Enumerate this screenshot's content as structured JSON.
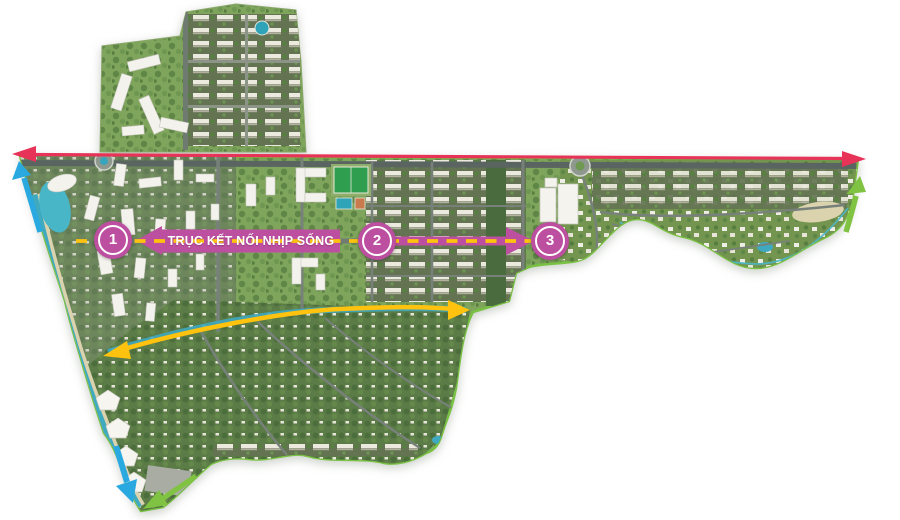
{
  "axis": {
    "label": "TRỤC KẾT NỐI NHỊP SỐNG",
    "markers": [
      {
        "label": "1"
      },
      {
        "label": "2"
      },
      {
        "label": "3"
      }
    ]
  },
  "icons": {
    "main_road": "red-double-arrow",
    "river_upper_left": "blue-arrow-up",
    "river_lower_left": "blue-arrow-down",
    "greenway_right": "green-arrow-up",
    "greenway_bottom": "green-arrow-left",
    "secondary_axis": "yellow-double-arrow"
  },
  "colors": {
    "magenta": "#bc4f9f",
    "yellow": "#ffc20e",
    "red": "#e73358",
    "blue": "#2aa9e0",
    "green_arrow": "#80c342",
    "boundary_green": "#79c143",
    "water": "#3fa9bf"
  }
}
